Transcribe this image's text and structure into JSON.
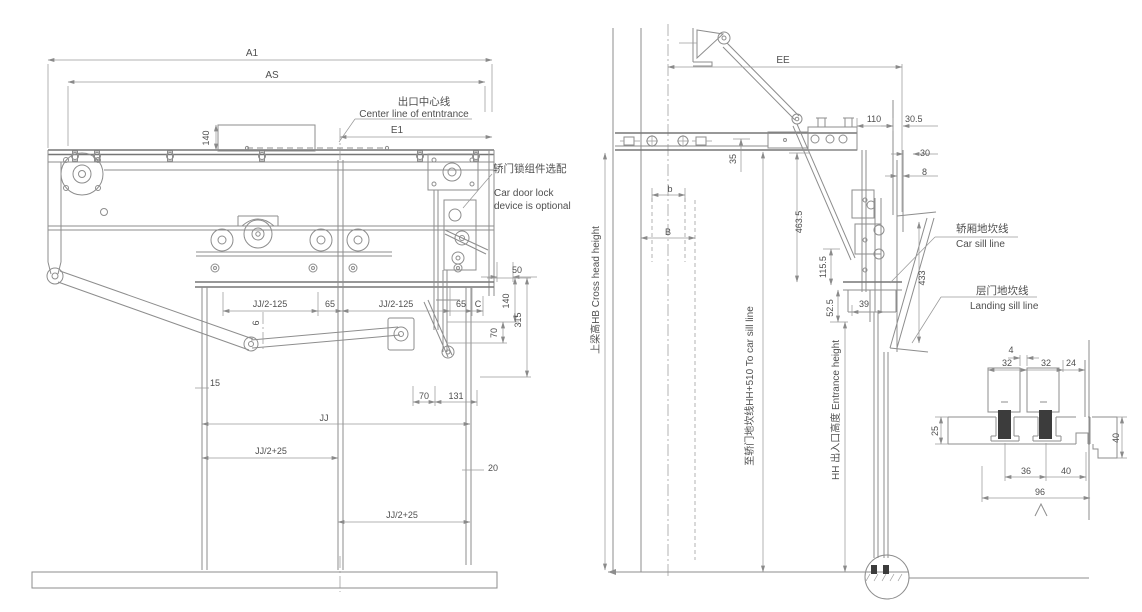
{
  "drawing": {
    "front": {
      "a1": "A1",
      "as": "AS",
      "e1": "E1",
      "center_zh": "出口中心线",
      "center_en": "Center line of entntrance",
      "dim140_top": "140",
      "lock_zh": "轿门锁组件选配",
      "lock_en1": "Car door lock",
      "lock_en2": "device is optional",
      "dim50": "50",
      "jj2m125_l": "JJ/2-125",
      "dim65_l": "65",
      "jj2m125_r": "JJ/2-125",
      "dim65_r": "65",
      "dimC": "C",
      "dim140_r": "140",
      "dim315": "315",
      "dim70_v": "70",
      "dim6": "6",
      "dim15": "15",
      "dim70_h": "70",
      "dim131": "131",
      "jj": "JJ",
      "jj2p25_l": "JJ/2+25",
      "dim20": "20",
      "jj2p25_r": "JJ/2+25"
    },
    "side": {
      "ee": "EE",
      "dim110": "110",
      "dim30_5": "30.5",
      "dim30": "30",
      "dim8": "8",
      "dim35": "35",
      "dim463_5": "463.5",
      "dim115_5": "115.5",
      "dim52_5": "52.5",
      "dim39": "39",
      "dim433": "433",
      "b_small": "b",
      "b_cap": "B",
      "car_sill_zh": "轿厢地坎线",
      "car_sill_en": "Car sill line",
      "landing_sill_zh": "层门地坎线",
      "landing_sill_en": "Landing sill line",
      "crosshead": "上梁高HB Cross head height",
      "to_car_sill": "至轿门地坎线HH+510 To car sill line",
      "entrance_h": "HH 出入口高度 Entrance height"
    },
    "section": {
      "dim4": "4",
      "dim32_l": "32",
      "dim32_r": "32",
      "dim24": "24",
      "dim25": "25",
      "dim40_r": "40",
      "dim36": "36",
      "dim40_b": "40",
      "dim96": "96"
    },
    "colors": {
      "line": "#8d8d8d",
      "dark_line": "#767676",
      "text": "#4f4f4f",
      "shoe": "#3c3c3c",
      "background": "#ffffff"
    }
  }
}
